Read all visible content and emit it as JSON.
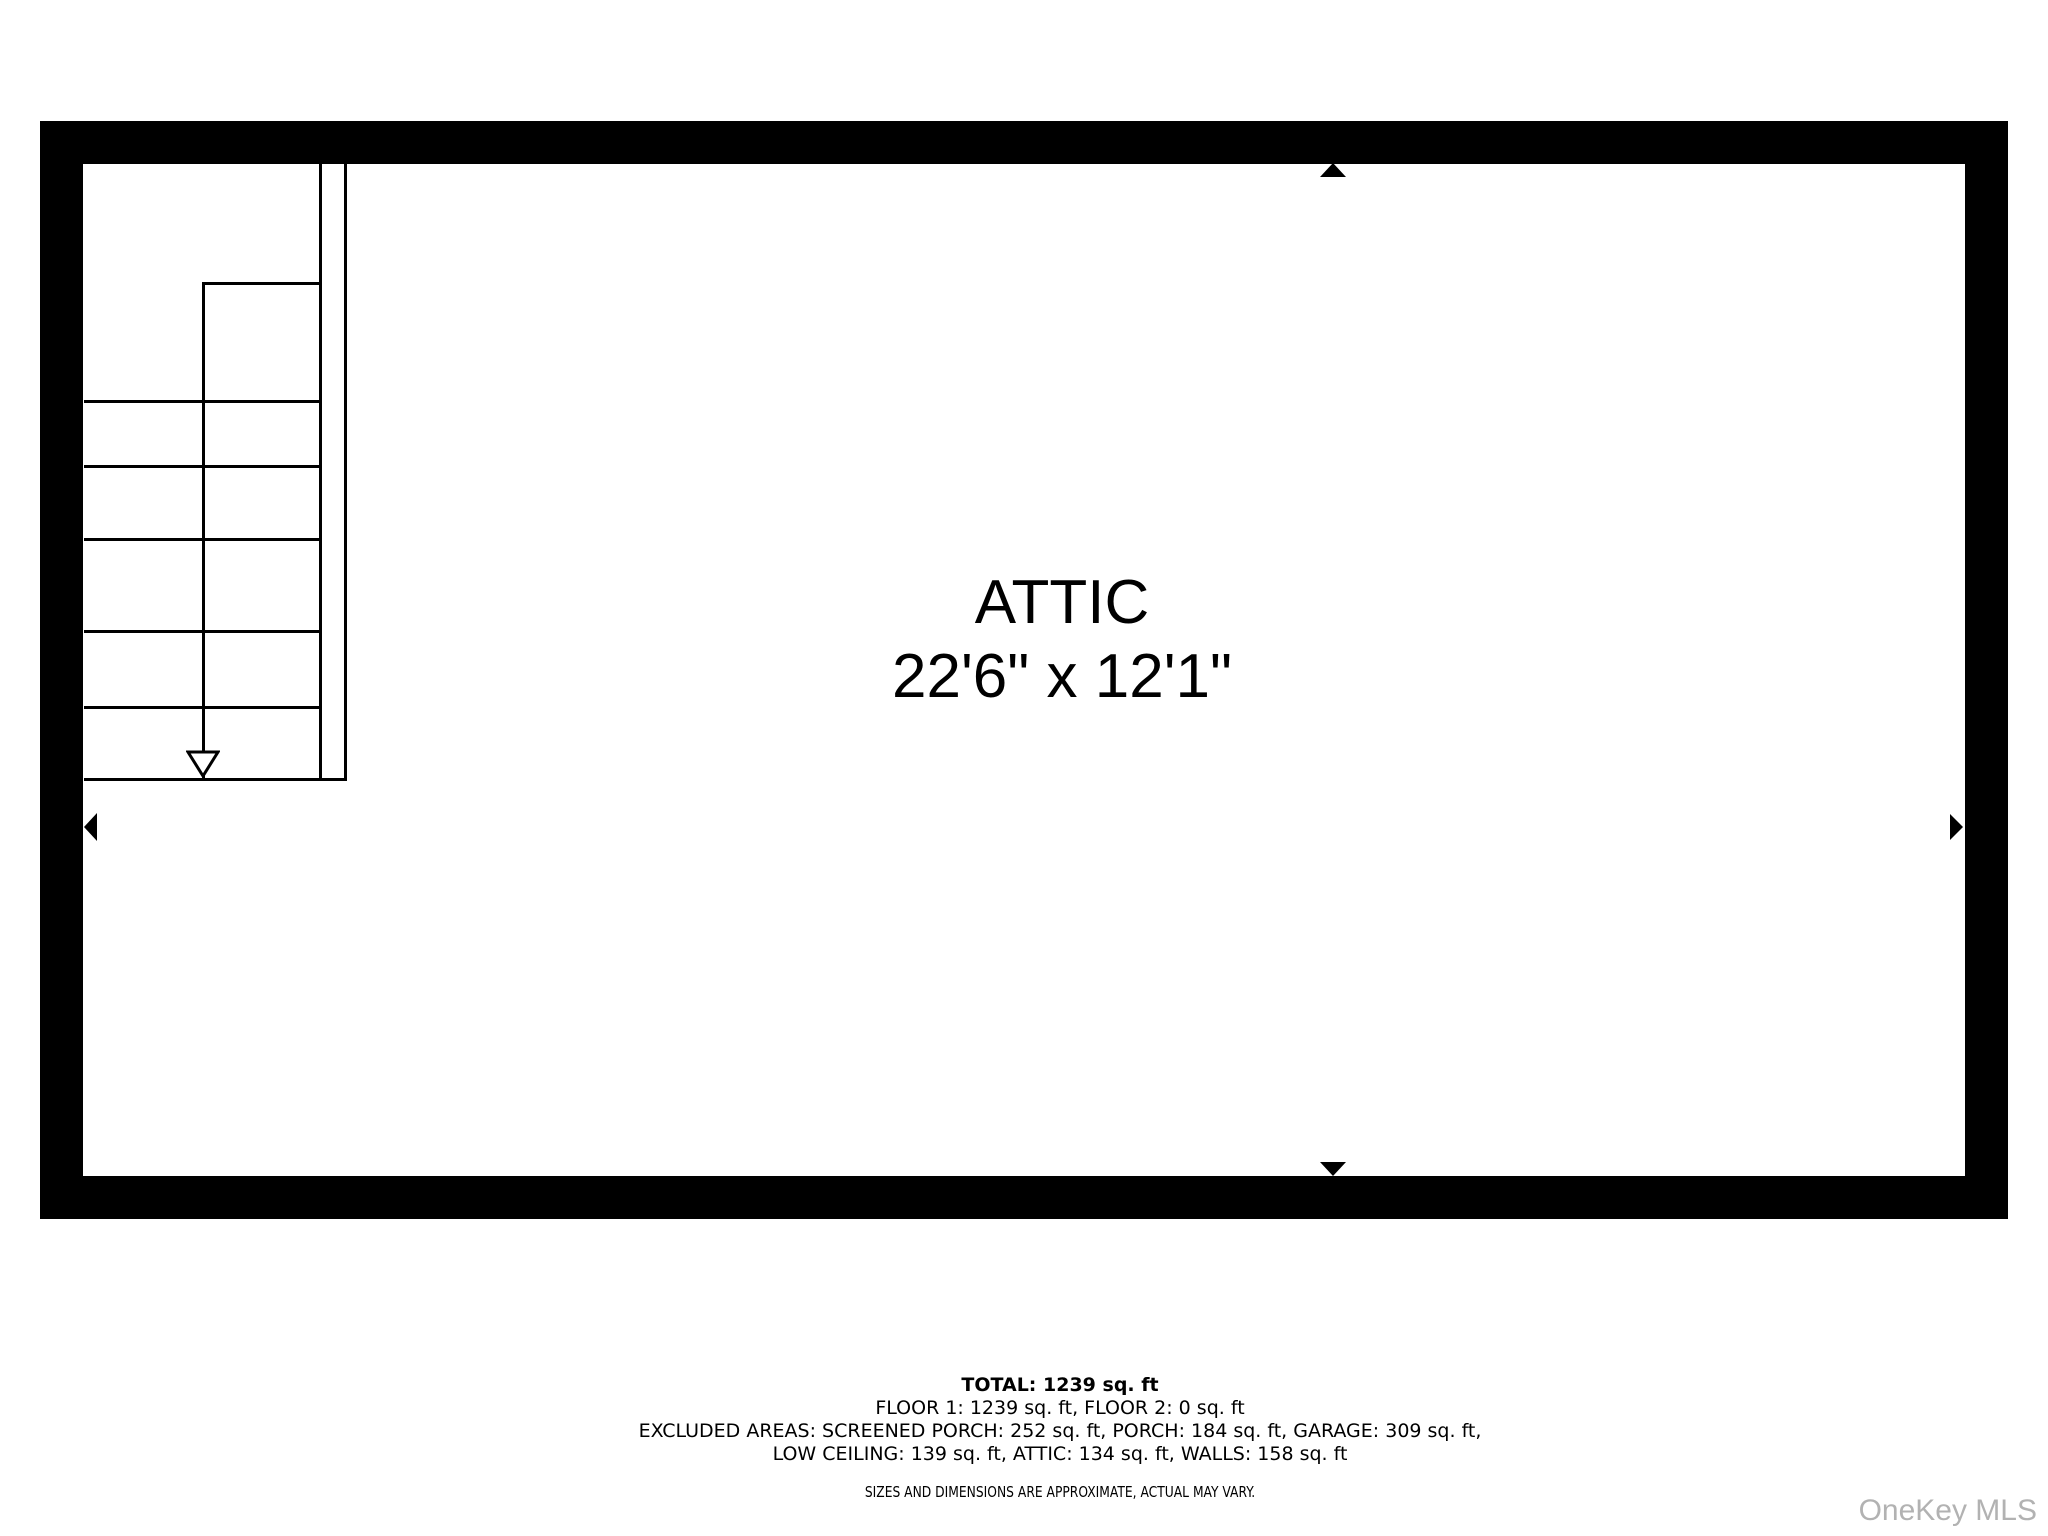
{
  "floor_plan": {
    "room_label": "ATTIC",
    "room_dimensions": "22'6\" x 12'1\"",
    "wall_color": "#000000",
    "line_color": "#000000",
    "background_color": "#ffffff",
    "markers": [
      "up",
      "down",
      "left",
      "right"
    ],
    "stairs": {
      "direction_arrow": "down",
      "step_count": 6
    }
  },
  "summary": {
    "total": "TOTAL: 1239 sq. ft",
    "floors": "FLOOR 1: 1239 sq. ft, FLOOR 2: 0 sq. ft",
    "excluded_line1": "EXCLUDED AREAS: SCREENED PORCH: 252 sq. ft, PORCH: 184 sq. ft, GARAGE: 309 sq. ft,",
    "excluded_line2": "LOW CEILING: 139 sq. ft, ATTIC: 134 sq. ft, WALLS: 158 sq. ft",
    "disclaimer": "SIZES AND DIMENSIONS ARE APPROXIMATE, ACTUAL MAY VARY."
  },
  "watermark": {
    "text": "OneKey MLS",
    "color": "#b2b2b2"
  }
}
